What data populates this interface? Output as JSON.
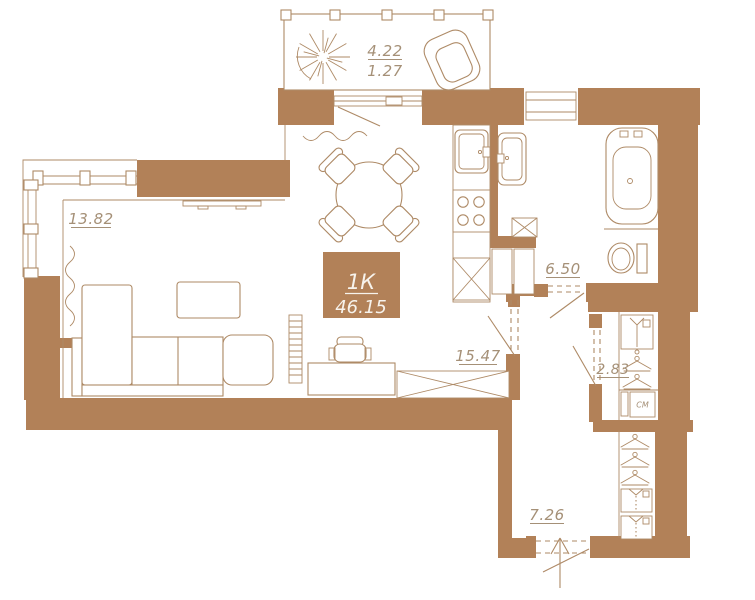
{
  "plan": {
    "badge": {
      "type_label": "1К",
      "total_area": "46.15"
    },
    "rooms": {
      "balcony": {
        "area": "4.22",
        "area_reduced": "1.27"
      },
      "living_room": {
        "area": "13.82"
      },
      "kitchen_living": {
        "area": "15.47"
      },
      "bathroom": {
        "area": "6.50"
      },
      "closet": {
        "area": "2.83",
        "washing_machine_label": "СМ"
      },
      "hallway": {
        "area": "7.26"
      }
    }
  },
  "colors": {
    "wall": "#b28158",
    "outline": "#ae8a66",
    "label": "#a59077",
    "badge_text": "#f7f3ec",
    "floor": "#ffffff"
  }
}
